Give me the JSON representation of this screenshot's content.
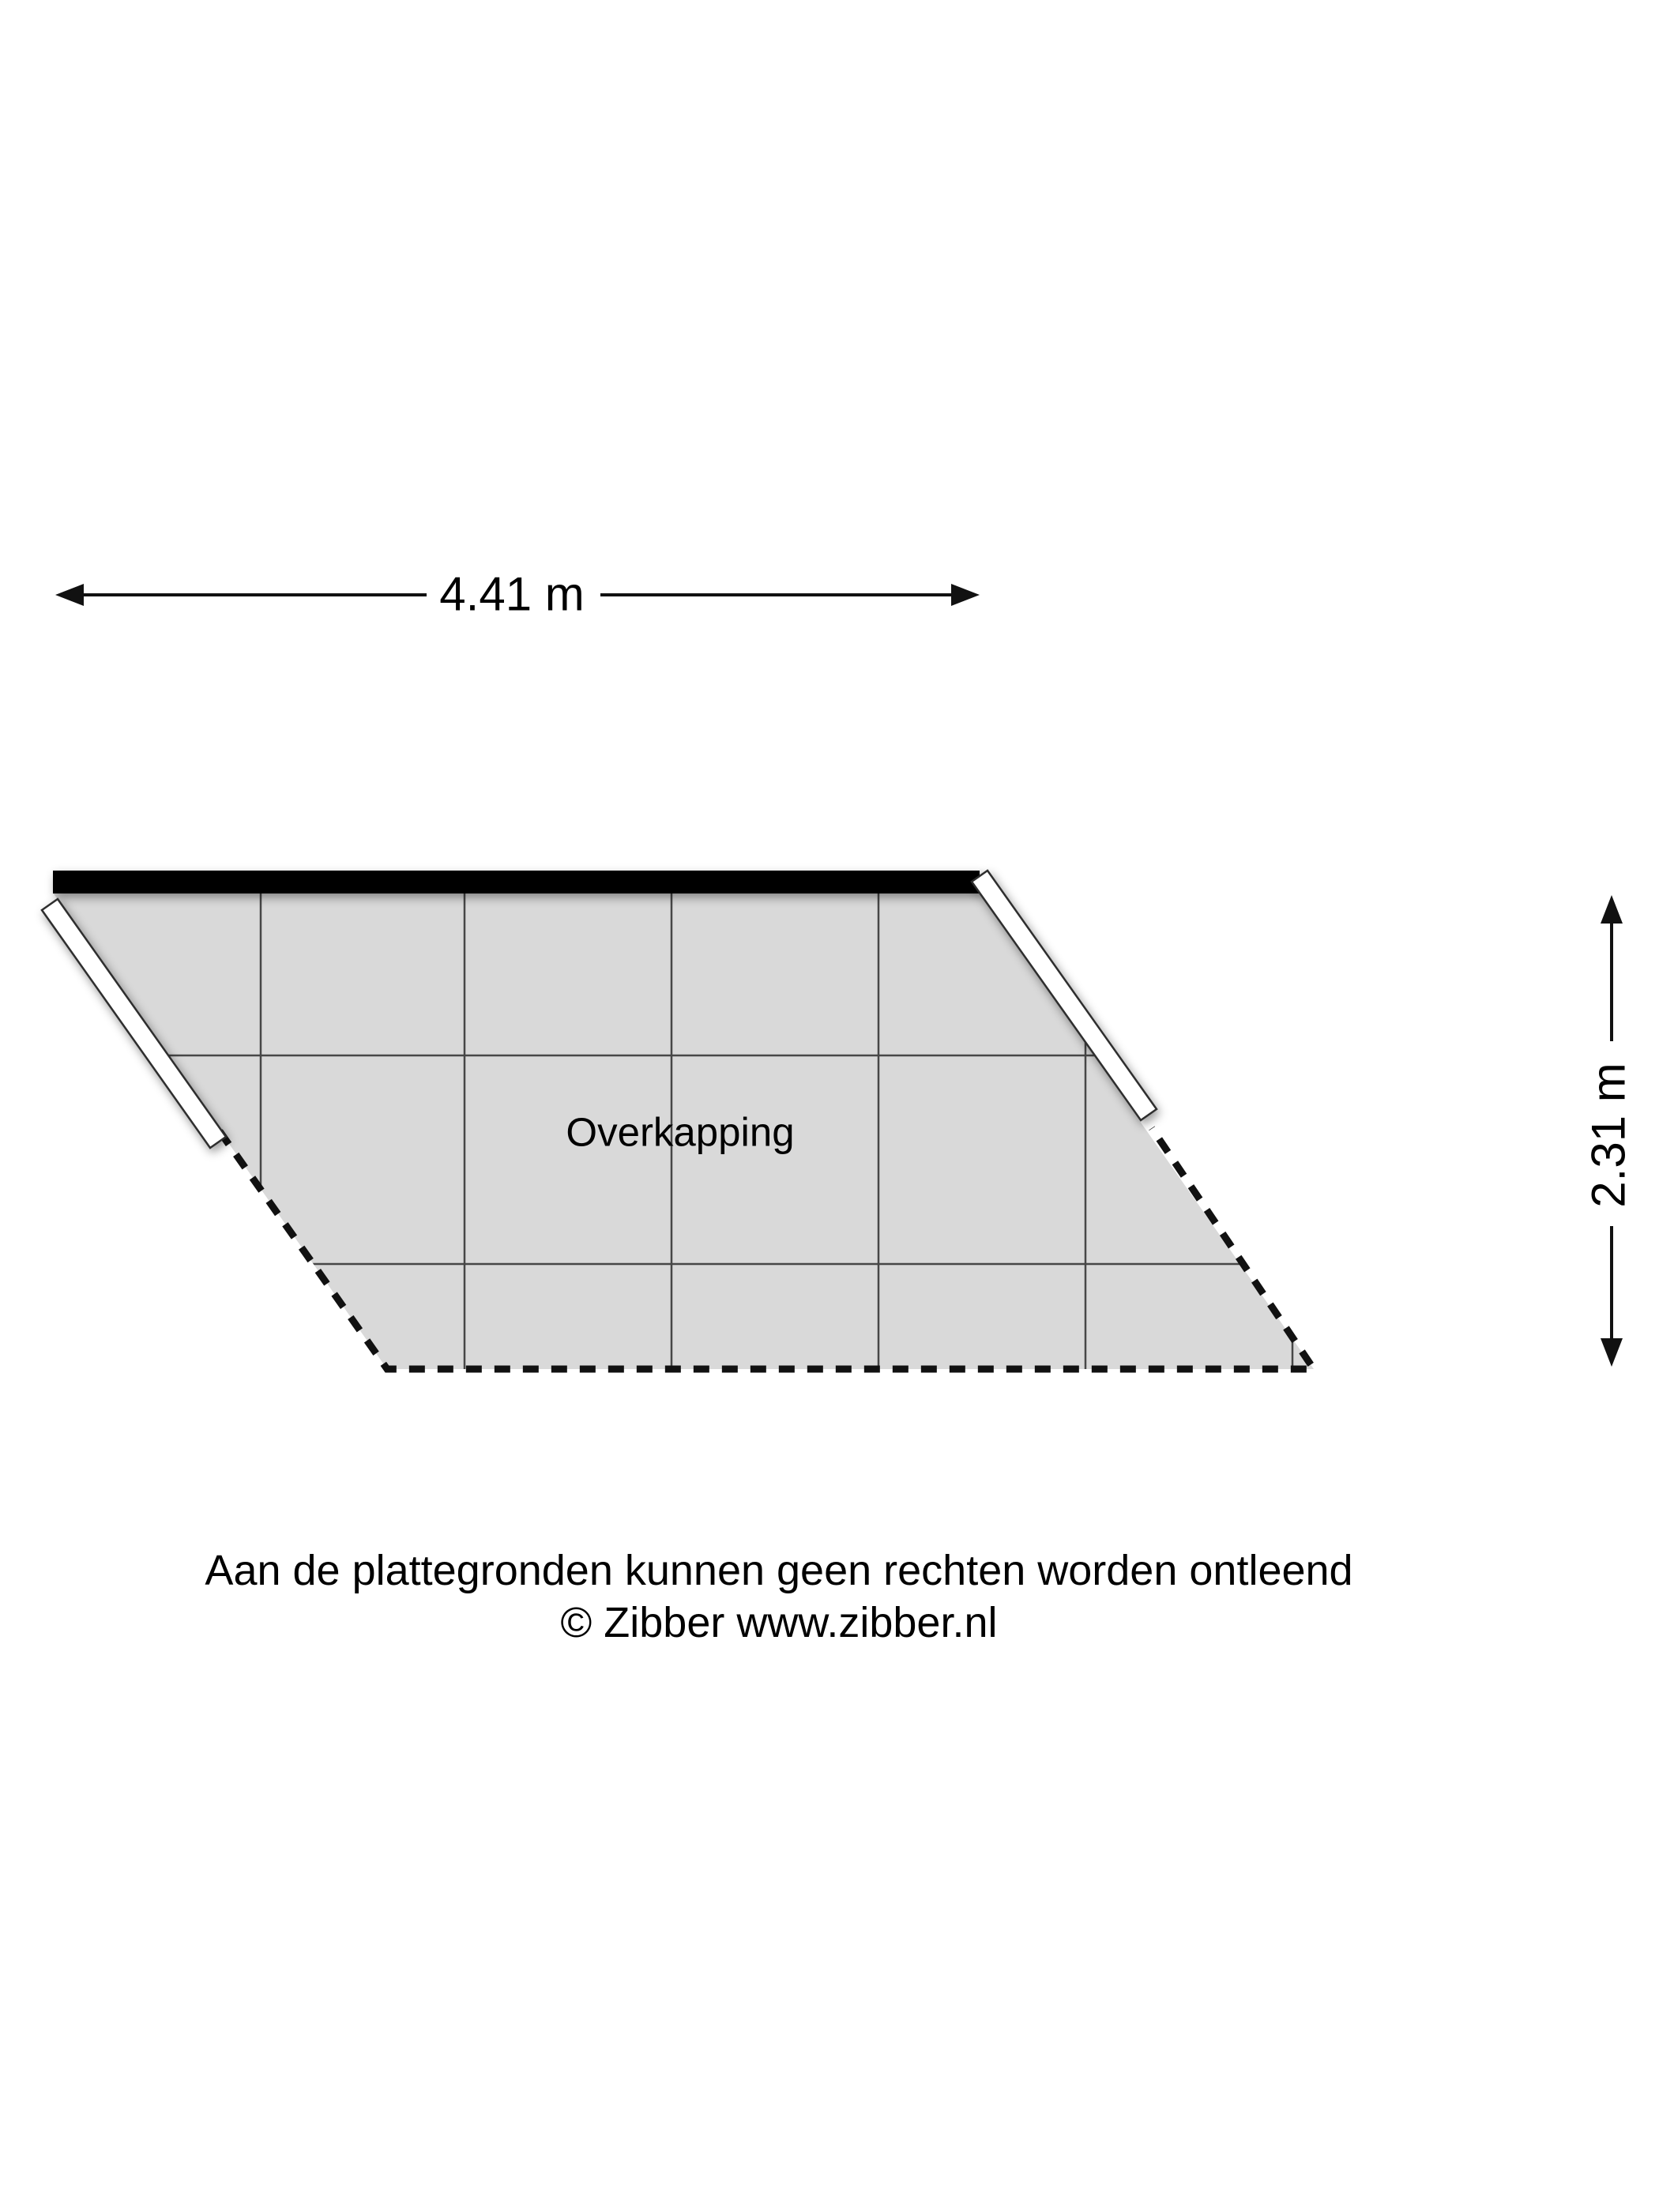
{
  "plan": {
    "room_label": "Overkapping",
    "dimensions": {
      "width": "4.41 m",
      "height": "2.31 m"
    },
    "colors": {
      "floor_fill": "#d9d9d9",
      "grid_line": "#474747",
      "solid_wall": "#000000",
      "open_wall_fill": "#ffffff",
      "open_wall_outline": "#2e2e2e",
      "dashed_edge": "#111111",
      "dimension_line": "#111111"
    }
  },
  "footer": {
    "disclaimer": "Aan de plattegronden kunnen geen rechten worden ontleend",
    "copyright": "© Zibber www.zibber.nl"
  }
}
